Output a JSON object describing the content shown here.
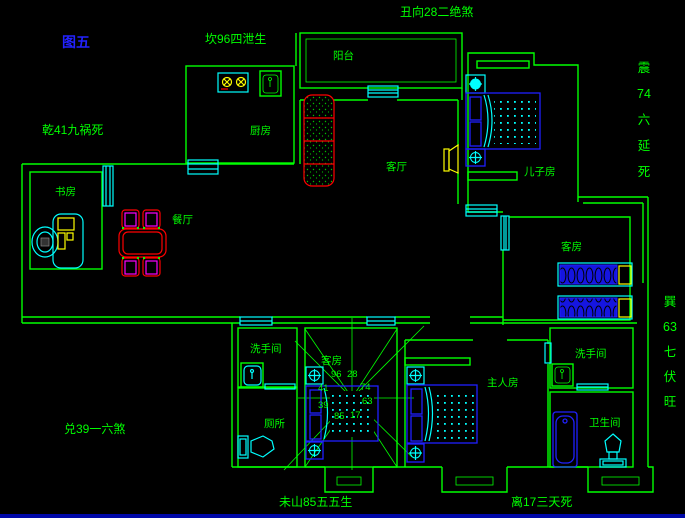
{
  "figure_label": "图五",
  "annotations": {
    "kan_north": "坎96四泄生",
    "chou_northeast": "丑向28二绝煞",
    "qian_northwest": "乾41九祸死",
    "dui_west": "兑39一六煞",
    "wei_southwest": "未山85五五生",
    "li_south": "离17三天死",
    "zhen_east": [
      "震",
      "74",
      "六",
      "延",
      "死"
    ],
    "xun_southeast": [
      "巽",
      "63",
      "七",
      "伏",
      "旺"
    ]
  },
  "rooms": {
    "balcony": "阳台",
    "kitchen": "厨房",
    "study": "书房",
    "dining": "餐厅",
    "living": "客厅",
    "sons_room": "儿子房",
    "guest_room": "客房",
    "inner_bedroom": "客房",
    "washroom": "洗手间",
    "toilet": "厕所",
    "master_bedroom": "主人房",
    "washroom_2": "洗手间",
    "bathroom": "卫生间"
  },
  "compass_numbers": [
    "96",
    "28",
    "41",
    "74",
    "39",
    "63",
    "85",
    "17"
  ],
  "colors": {
    "wall_green": "#00ff00",
    "fixture_cyan": "#00ffff",
    "furniture_blue": "#2020ff",
    "accent_red": "#ff0000",
    "accent_magenta": "#ff00ff",
    "accent_yellow": "#ffff00",
    "figure_blue": "#2222ff",
    "background": "#000000"
  }
}
